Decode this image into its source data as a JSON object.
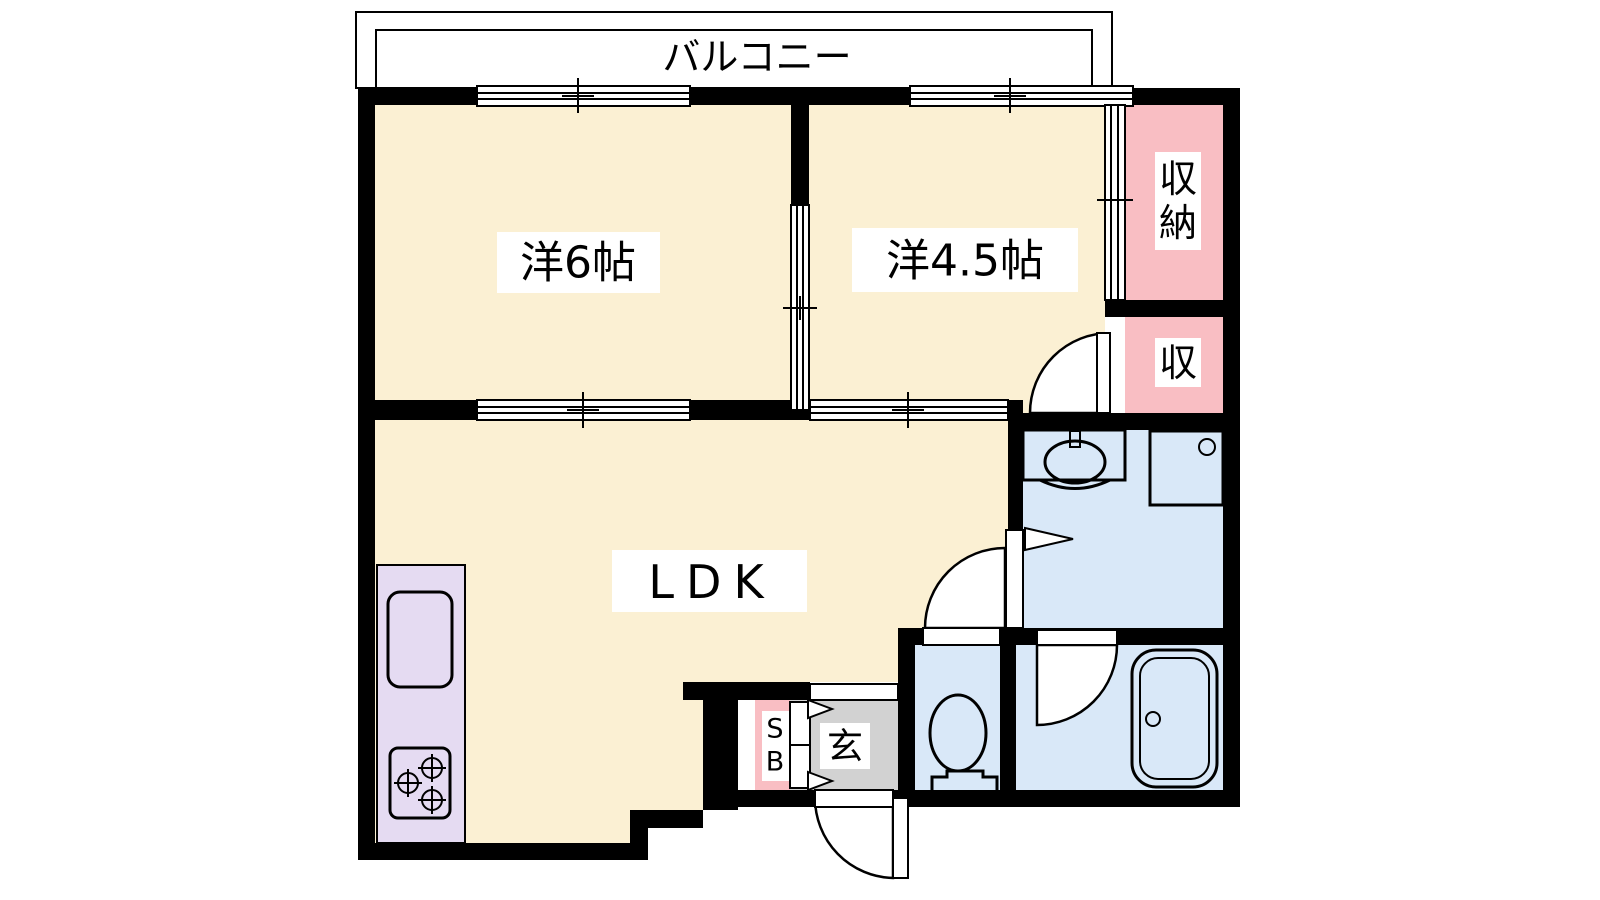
{
  "labels": {
    "balcony": "バルコニー",
    "bedroom6": "洋6帖",
    "bedroom45": "洋4.5帖",
    "ldk": "LDK",
    "storage_large": "収納",
    "storage_large_char_top": "収",
    "storage_large_char_bottom": "納",
    "storage_small": "収",
    "entrance": "玄",
    "shoe_box": "SB",
    "shoe_box_char_top": "S",
    "shoe_box_char_bottom": "B"
  },
  "colors": {
    "wall": "#000000",
    "room_floor": "#FBF0D3",
    "closet": "#F9BEC3",
    "wet_area": "#D9E8F8",
    "kitchen_counter": "#E5DBF2",
    "balcony": "#D2D2D2",
    "entrance_floor": "#D2D2D2",
    "label_background": "#FFFFFF"
  }
}
